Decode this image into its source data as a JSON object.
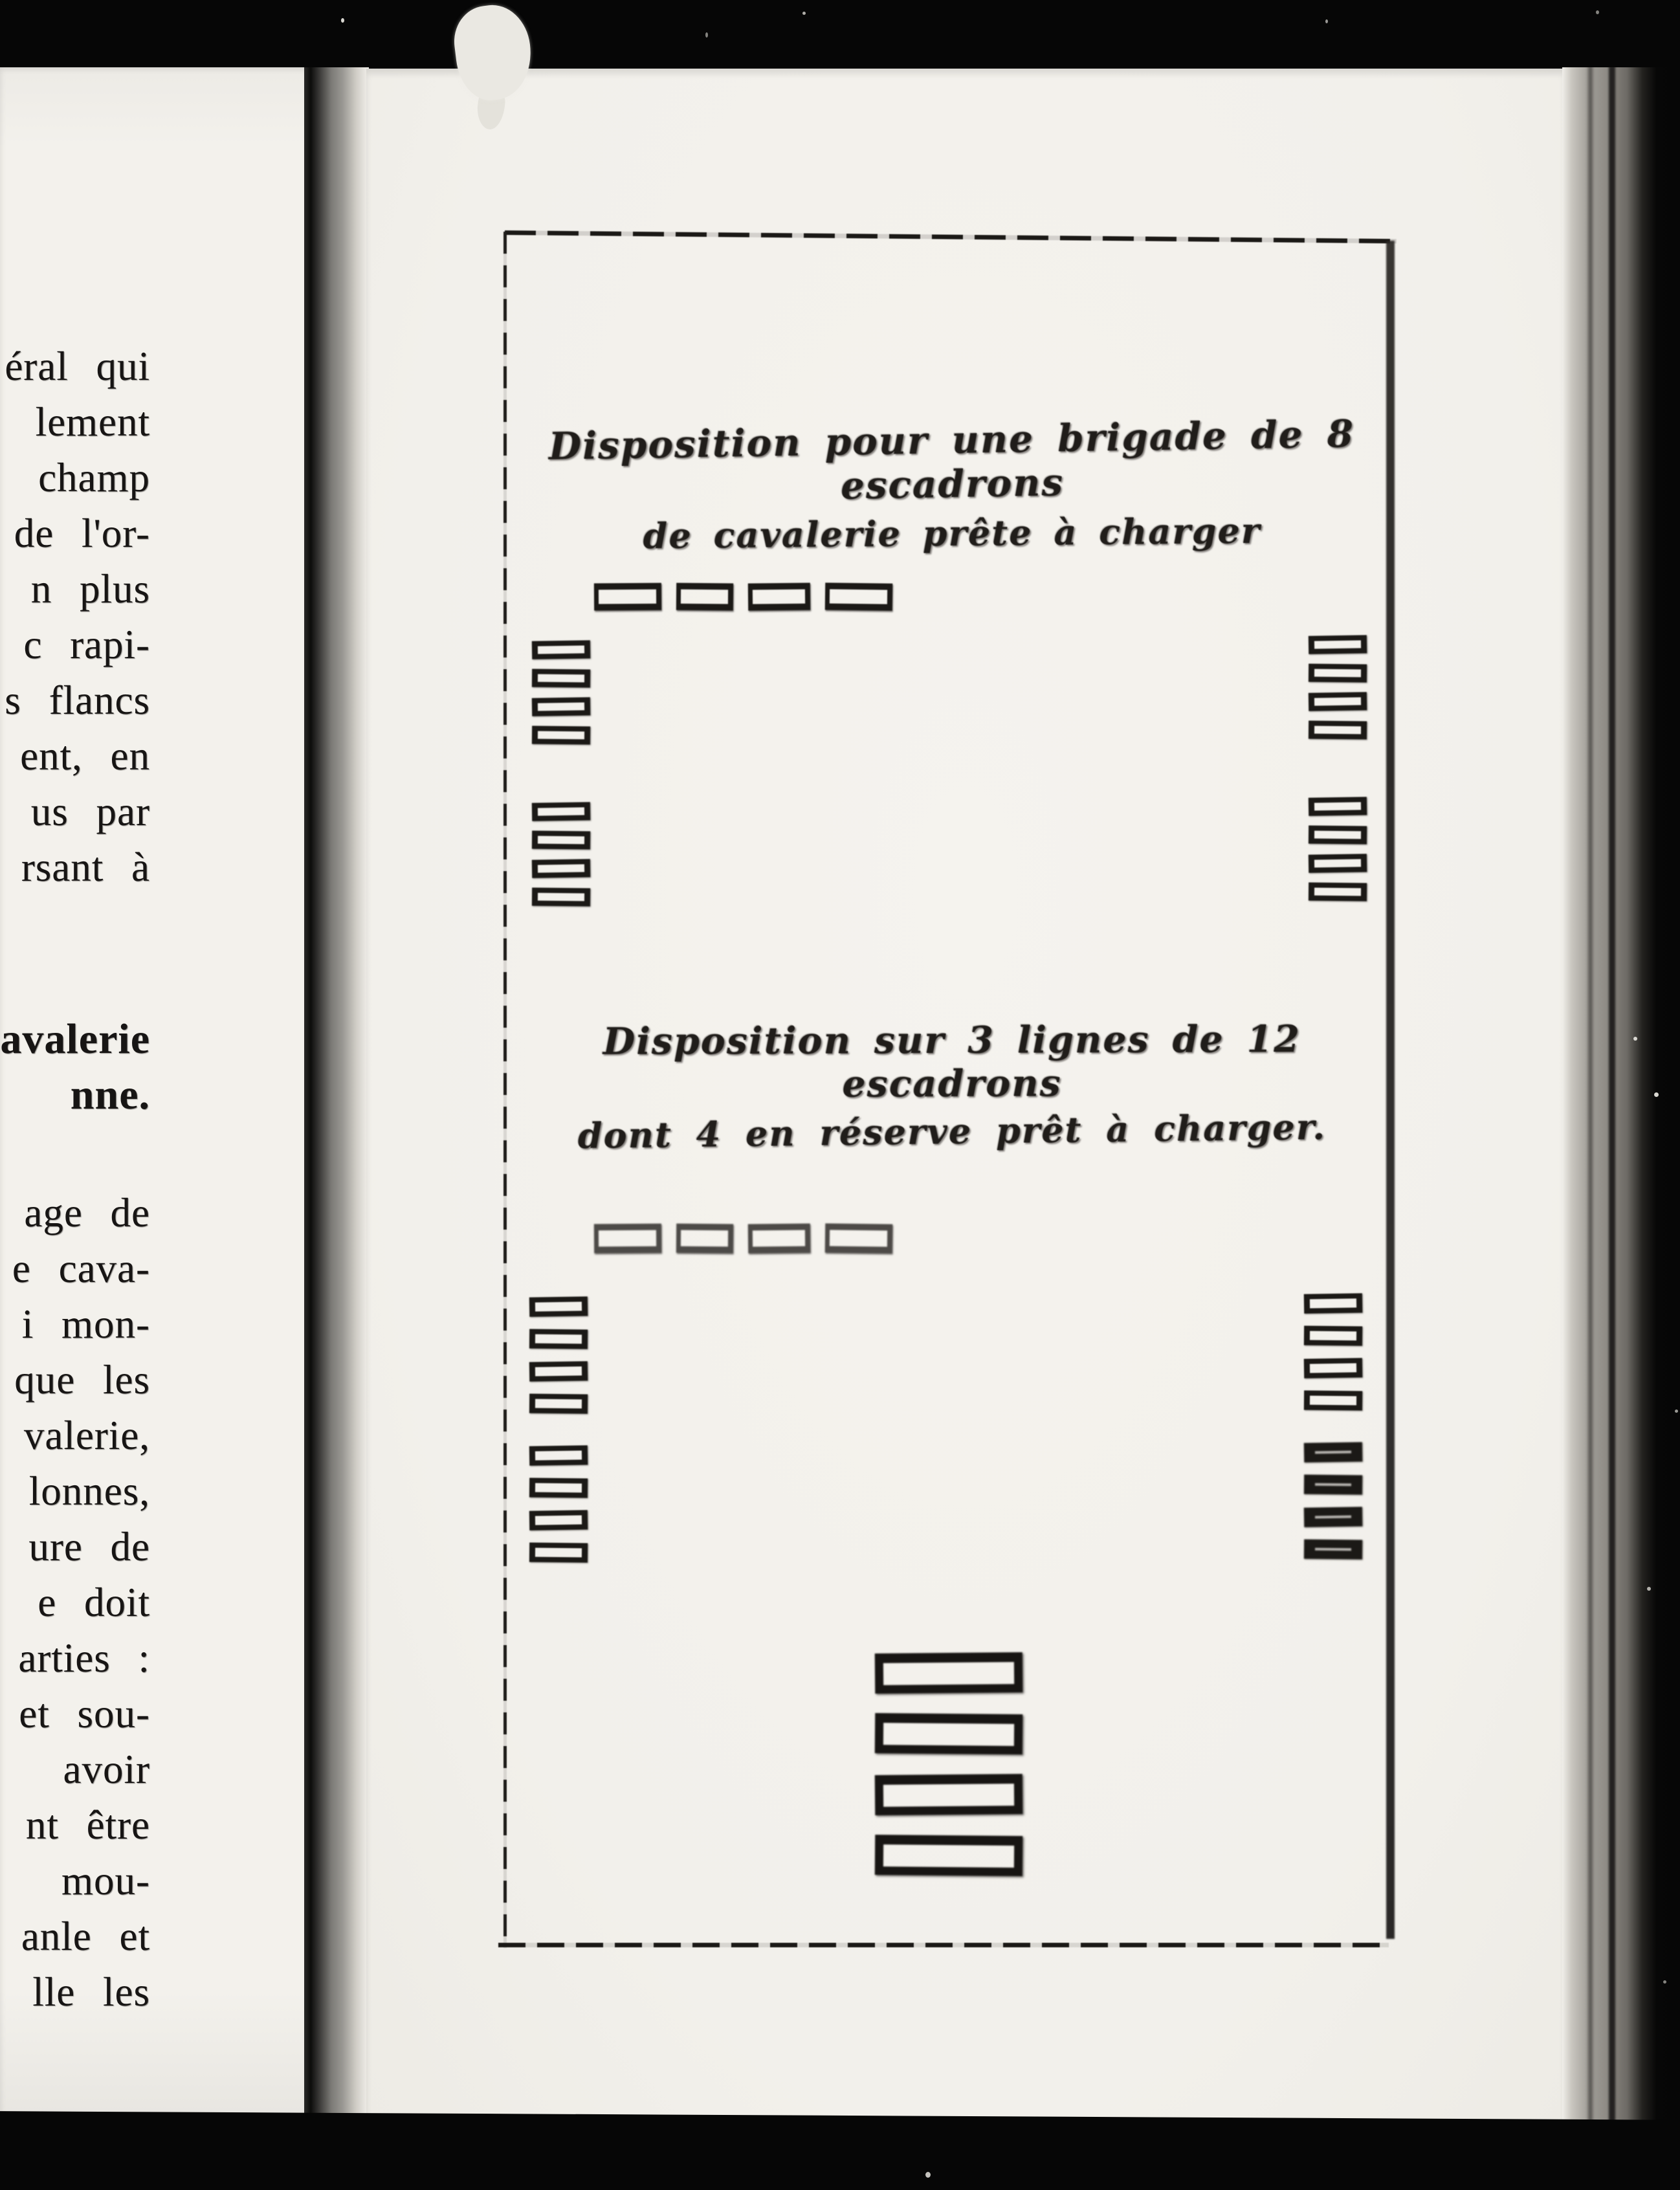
{
  "left_page": {
    "lines": [
      {
        "text": "éral qui"
      },
      {
        "text": "lement"
      },
      {
        "text": "champ"
      },
      {
        "text": "de l'or-"
      },
      {
        "text": "n plus"
      },
      {
        "text": "c rapi-"
      },
      {
        "text": "s flancs"
      },
      {
        "text": "ent, en"
      },
      {
        "text": "us par"
      },
      {
        "text": "rsant à"
      },
      {
        "text": "cavalerie",
        "bold": true,
        "gap_before": 180
      },
      {
        "text": "nne.",
        "bold": true
      },
      {
        "text": "age de",
        "gap_before": 96
      },
      {
        "text": "e cava-"
      },
      {
        "text": "i mon-"
      },
      {
        "text": "que les"
      },
      {
        "text": "valerie,"
      },
      {
        "text": "lonnes,"
      },
      {
        "text": "ure de"
      },
      {
        "text": "e doit"
      },
      {
        "text": "arties :"
      },
      {
        "text": "et sou-"
      },
      {
        "text": "avoir"
      },
      {
        "text": "nt être"
      },
      {
        "text": "mou-"
      },
      {
        "text": "anle et"
      },
      {
        "text": "lle les"
      }
    ]
  },
  "figures": [
    {
      "title_line1": "Disposition pour une brigade de 8 escadrons",
      "title_line2": "de cavalerie prête à charger",
      "front_line_count": 4,
      "left_column_groups": [
        4,
        4
      ],
      "right_column_groups": [
        4,
        4
      ]
    },
    {
      "title_line1": "Disposition sur 3 lignes de 12 escadrons",
      "title_line2": "dont 4 en réserve prêt à charger.",
      "front_line_count": 4,
      "left_column_groups": [
        4,
        4
      ],
      "right_column_groups": [
        4,
        4
      ],
      "reserve_count": 4
    }
  ],
  "colors": {
    "paper": "#f3f1ec",
    "ink": "#1b1916",
    "background": "#060606"
  }
}
